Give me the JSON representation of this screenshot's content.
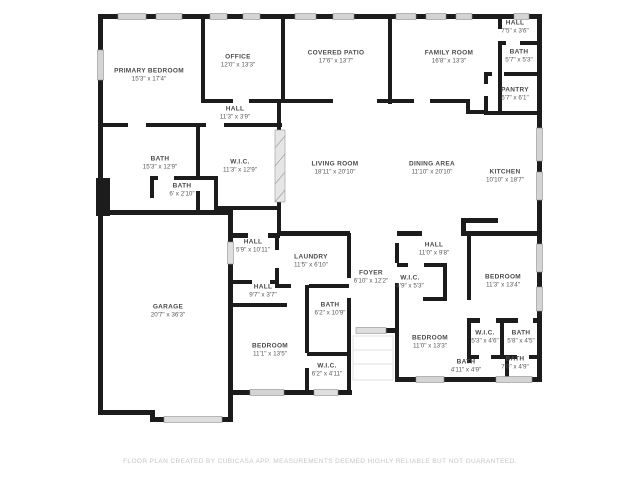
{
  "plan": {
    "title": "Floor Plan",
    "colors": {
      "wall": "#1c1c1c",
      "window": "#d4d4d4",
      "door_marker": "#d9d9d9",
      "label_text": "#4a4a4a",
      "footer_text": "#c6c6c6",
      "background": "#ffffff"
    }
  },
  "footer": {
    "text": "FLOOR PLAN CREATED BY CUBICASA APP. MEASUREMENTS DEEMED HIGHLY RELIABLE BUT NOT GUARANTEED."
  },
  "rooms": [
    {
      "id": "primary-bedroom",
      "name": "PRIMARY BEDROOM",
      "dims": "15'3\" x 17'4\"",
      "x": 149,
      "y": 76
    },
    {
      "id": "office",
      "name": "OFFICE",
      "dims": "12'0\" x 13'3\"",
      "x": 238,
      "y": 62
    },
    {
      "id": "covered-patio",
      "name": "COVERED PATIO",
      "dims": "17'6\" x 13'7\"",
      "x": 336,
      "y": 58
    },
    {
      "id": "family-room",
      "name": "FAMILY ROOM",
      "dims": "16'8\" x 13'3\"",
      "x": 449,
      "y": 58
    },
    {
      "id": "hall-top-right",
      "name": "HALL",
      "dims": "7'5\" x 3'6\"",
      "x": 515,
      "y": 28
    },
    {
      "id": "bath-top-right",
      "name": "BATH",
      "dims": "5'7\" x 5'3\"",
      "x": 519,
      "y": 57
    },
    {
      "id": "pantry",
      "name": "PANTRY",
      "dims": "5'7\" x 6'1\"",
      "x": 515,
      "y": 95
    },
    {
      "id": "hall-upper",
      "name": "HALL",
      "dims": "11'3\" x 3'9\"",
      "x": 235,
      "y": 114
    },
    {
      "id": "bath-primary",
      "name": "BATH",
      "dims": "15'3\" x 12'9\"",
      "x": 160,
      "y": 164
    },
    {
      "id": "wic-primary",
      "name": "W.I.C.",
      "dims": "11'3\" x 12'9\"",
      "x": 240,
      "y": 167
    },
    {
      "id": "bath-small",
      "name": "BATH",
      "dims": "6' x 2'10\"",
      "x": 182,
      "y": 191
    },
    {
      "id": "living-room",
      "name": "LIVING ROOM",
      "dims": "18'11\" x 20'10\"",
      "x": 335,
      "y": 169
    },
    {
      "id": "dining-area",
      "name": "DINING AREA",
      "dims": "11'10\" x 20'10\"",
      "x": 432,
      "y": 169
    },
    {
      "id": "kitchen",
      "name": "KITCHEN",
      "dims": "10'10\" x 18'7\"",
      "x": 505,
      "y": 177
    },
    {
      "id": "hall-mid-left",
      "name": "HALL",
      "dims": "5'9\" x 10'11\"",
      "x": 253,
      "y": 247
    },
    {
      "id": "laundry",
      "name": "LAUNDRY",
      "dims": "11'5\" x 6'10\"",
      "x": 311,
      "y": 262
    },
    {
      "id": "foyer",
      "name": "FOYER",
      "dims": "6'10\" x 12'2\"",
      "x": 371,
      "y": 278
    },
    {
      "id": "hall-mid-right",
      "name": "HALL",
      "dims": "11'0\" x 9'8\"",
      "x": 434,
      "y": 250
    },
    {
      "id": "wic-hall",
      "name": "W.I.C.",
      "dims": "4'9\" x 5'3\"",
      "x": 410,
      "y": 283
    },
    {
      "id": "bedroom-right",
      "name": "BEDROOM",
      "dims": "11'3\" x 13'4\"",
      "x": 503,
      "y": 282
    },
    {
      "id": "hall-small",
      "name": "HALL",
      "dims": "9'7\" x 3'7\"",
      "x": 263,
      "y": 292
    },
    {
      "id": "bath-middle",
      "name": "BATH",
      "dims": "6'2\" x 10'9\"",
      "x": 330,
      "y": 310
    },
    {
      "id": "garage",
      "name": "GARAGE",
      "dims": "20'7\" x 36'3\"",
      "x": 168,
      "y": 312
    },
    {
      "id": "bedroom-bottom-mid",
      "name": "BEDROOM",
      "dims": "11'1\" x 13'5\"",
      "x": 270,
      "y": 351
    },
    {
      "id": "wic-bottom-mid",
      "name": "W.I.C.",
      "dims": "6'2\" x 4'11\"",
      "x": 327,
      "y": 371
    },
    {
      "id": "bedroom-bottom-right",
      "name": "BEDROOM",
      "dims": "11'0\" x 13'3\"",
      "x": 430,
      "y": 343
    },
    {
      "id": "wic-bottom-right",
      "name": "W.I.C.",
      "dims": "5'3\" x 4'6\"",
      "x": 485,
      "y": 338
    },
    {
      "id": "bath-cluster-top",
      "name": "BATH",
      "dims": "5'8\" x 4'5\"",
      "x": 521,
      "y": 338
    },
    {
      "id": "bath-cluster-left",
      "name": "BATH",
      "dims": "4'11\" x 4'9\"",
      "x": 466,
      "y": 367
    },
    {
      "id": "bath-cluster-right",
      "name": "BATH",
      "dims": "7'0\" x 4'9\"",
      "x": 515,
      "y": 364
    }
  ]
}
